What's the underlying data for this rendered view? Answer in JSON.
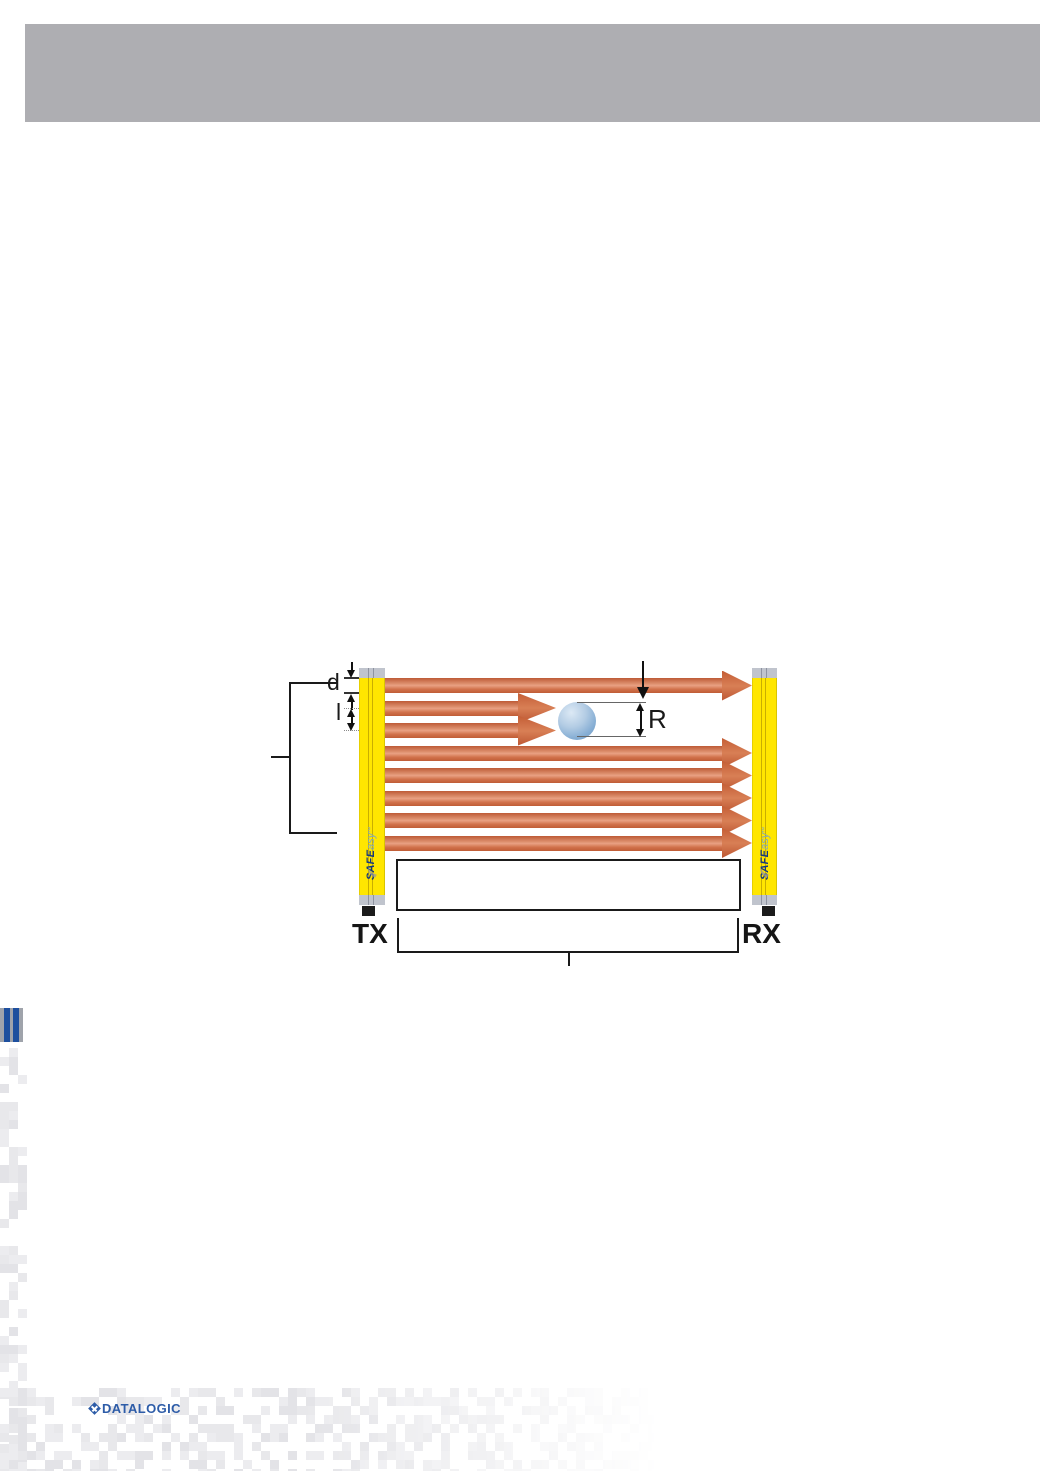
{
  "header": {
    "bar_color": "#aeaeb2"
  },
  "diagram": {
    "labels": {
      "beam_diameter": "d",
      "beam_interaxis": "l",
      "resolution": "R",
      "transmitter": "TX",
      "receiver": "RX"
    },
    "column_brand": {
      "bold": "SAFE",
      "light": "asy",
      "tm": "™"
    },
    "beams": {
      "count": 8,
      "interrupted": [
        2,
        3
      ]
    },
    "colors": {
      "column_yellow": "#ffe600",
      "cap_gray": "#c0c4cd",
      "beam_dark": "#c05c36",
      "beam_light": "#e9a183",
      "beam_head": "#cd6843",
      "test_object_blue": "#86aed4",
      "dimension_black": "#1a1a1a"
    }
  },
  "footer": {
    "logo_text": "DATALOGIC",
    "logo_color": "#2d5ca8"
  }
}
